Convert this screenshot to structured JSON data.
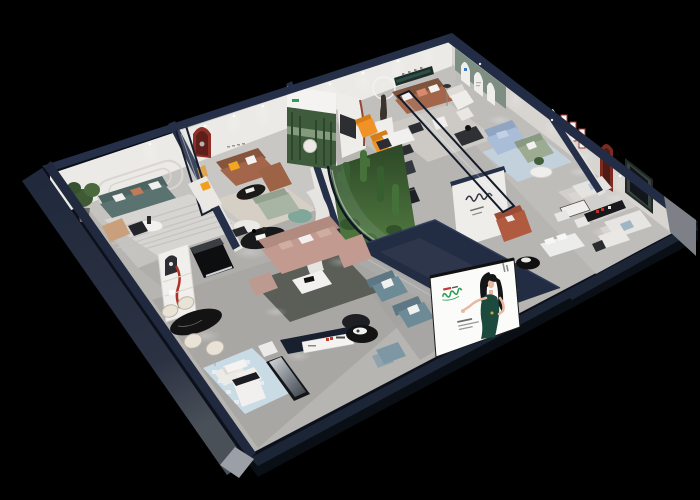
{
  "scene": {
    "description": "Night-time 3D isometric cutaway render of a multi-room furniture showroom, viewed from above on a black background",
    "background": "#000000"
  },
  "palette": {
    "floor_gray": "#b7b5b2",
    "wall_white": "#eceae6",
    "wall_top_navy": "#252f48",
    "band_navy": "#222c42",
    "exterior_navy": "#1b2436",
    "teal_sofa": "#5a7270",
    "brown_leather": "#a3664a",
    "orange_chair": "#f09225",
    "pink_sectional": "#c39a90",
    "light_blue_sofa": "#aabdd8",
    "sage_sofa": "#9cab92",
    "blue_armchair": "#6d8a97",
    "rust_bench": "#b05a40",
    "red_accent": "#b03226",
    "red_arch": "#8e2f26",
    "dark_red_niche": "#7c2b23",
    "green_arch_wall": "#7e8e83",
    "poster_forest_green": "#3e5c3b",
    "atrium_green": "#4c7240",
    "billboard_dress_green": "#1c4a3c",
    "logo_green": "#2f9e57",
    "rug_blue": "#c9dbe4"
  },
  "rooms": [
    {
      "id": "lounge-teal",
      "items": [
        "teal-fabric-sofa",
        "white-round-coffee-table",
        "tan-armchair",
        "potted-plant",
        "striped-area-rug",
        "oval-wall-relief"
      ]
    },
    {
      "id": "lounge-leather",
      "items": [
        "caramel-leather-sofa",
        "white-chaise-lounge",
        "black-oval-coffee-table",
        "red-arch-niche",
        "forest-poster",
        "glass-door"
      ]
    },
    {
      "id": "lounge-gallery",
      "items": [
        "leather-sofa",
        "sculpture-with-ring-lamp",
        "orange-armchairs",
        "round-dining-set",
        "recessed-wall-niche"
      ]
    },
    {
      "id": "arched-alcove",
      "items": [
        "green-arched-wall",
        "white-armchair",
        "ottoman",
        "floor-lamp"
      ]
    },
    {
      "id": "lounge-blue",
      "items": [
        "powder-blue-sofa",
        "sage-loveseat",
        "plant-side-table",
        "blue-rug",
        "red-frame-grid"
      ]
    },
    {
      "id": "suite-right",
      "items": [
        "white-sofa-pair",
        "media-panel",
        "maroon-arch-niche",
        "black-wall-shelf",
        "bistro-dining-set",
        "platform-bed",
        "black-pedestal-table"
      ]
    },
    {
      "id": "atrium",
      "items": [
        "cacti-garden",
        "white-hydrangeas",
        "curved-glass-wall"
      ]
    },
    {
      "id": "dining-display",
      "items": [
        "black-oval-marble-table",
        "cream-barrel-chairs",
        "display-cabinet-red-tube",
        "black-gloss-sideboard"
      ]
    },
    {
      "id": "lounge-blush",
      "items": [
        "blush-sectional-sofa",
        "white-coffee-table",
        "mauve-armchair",
        "sage-chaise",
        "teal-ottoman",
        "curved-screen-wall"
      ]
    },
    {
      "id": "front-gallery",
      "items": [
        "slate-blue-armchairs",
        "black-round-tray-table",
        "mosaic-rug",
        "white-modular-seat",
        "dark-display-benches",
        "white-cabinet",
        "fascia-signboard"
      ]
    }
  ],
  "billboard": {
    "subject": "illustrated-hostess-in-green-dress",
    "panel": "#fbfbf9"
  },
  "signage": [
    {
      "id": "fascia-sign",
      "accent": "#c0392b"
    },
    {
      "id": "script-logo-wall"
    },
    {
      "id": "poster-logo",
      "color": "#2f9e57"
    }
  ]
}
